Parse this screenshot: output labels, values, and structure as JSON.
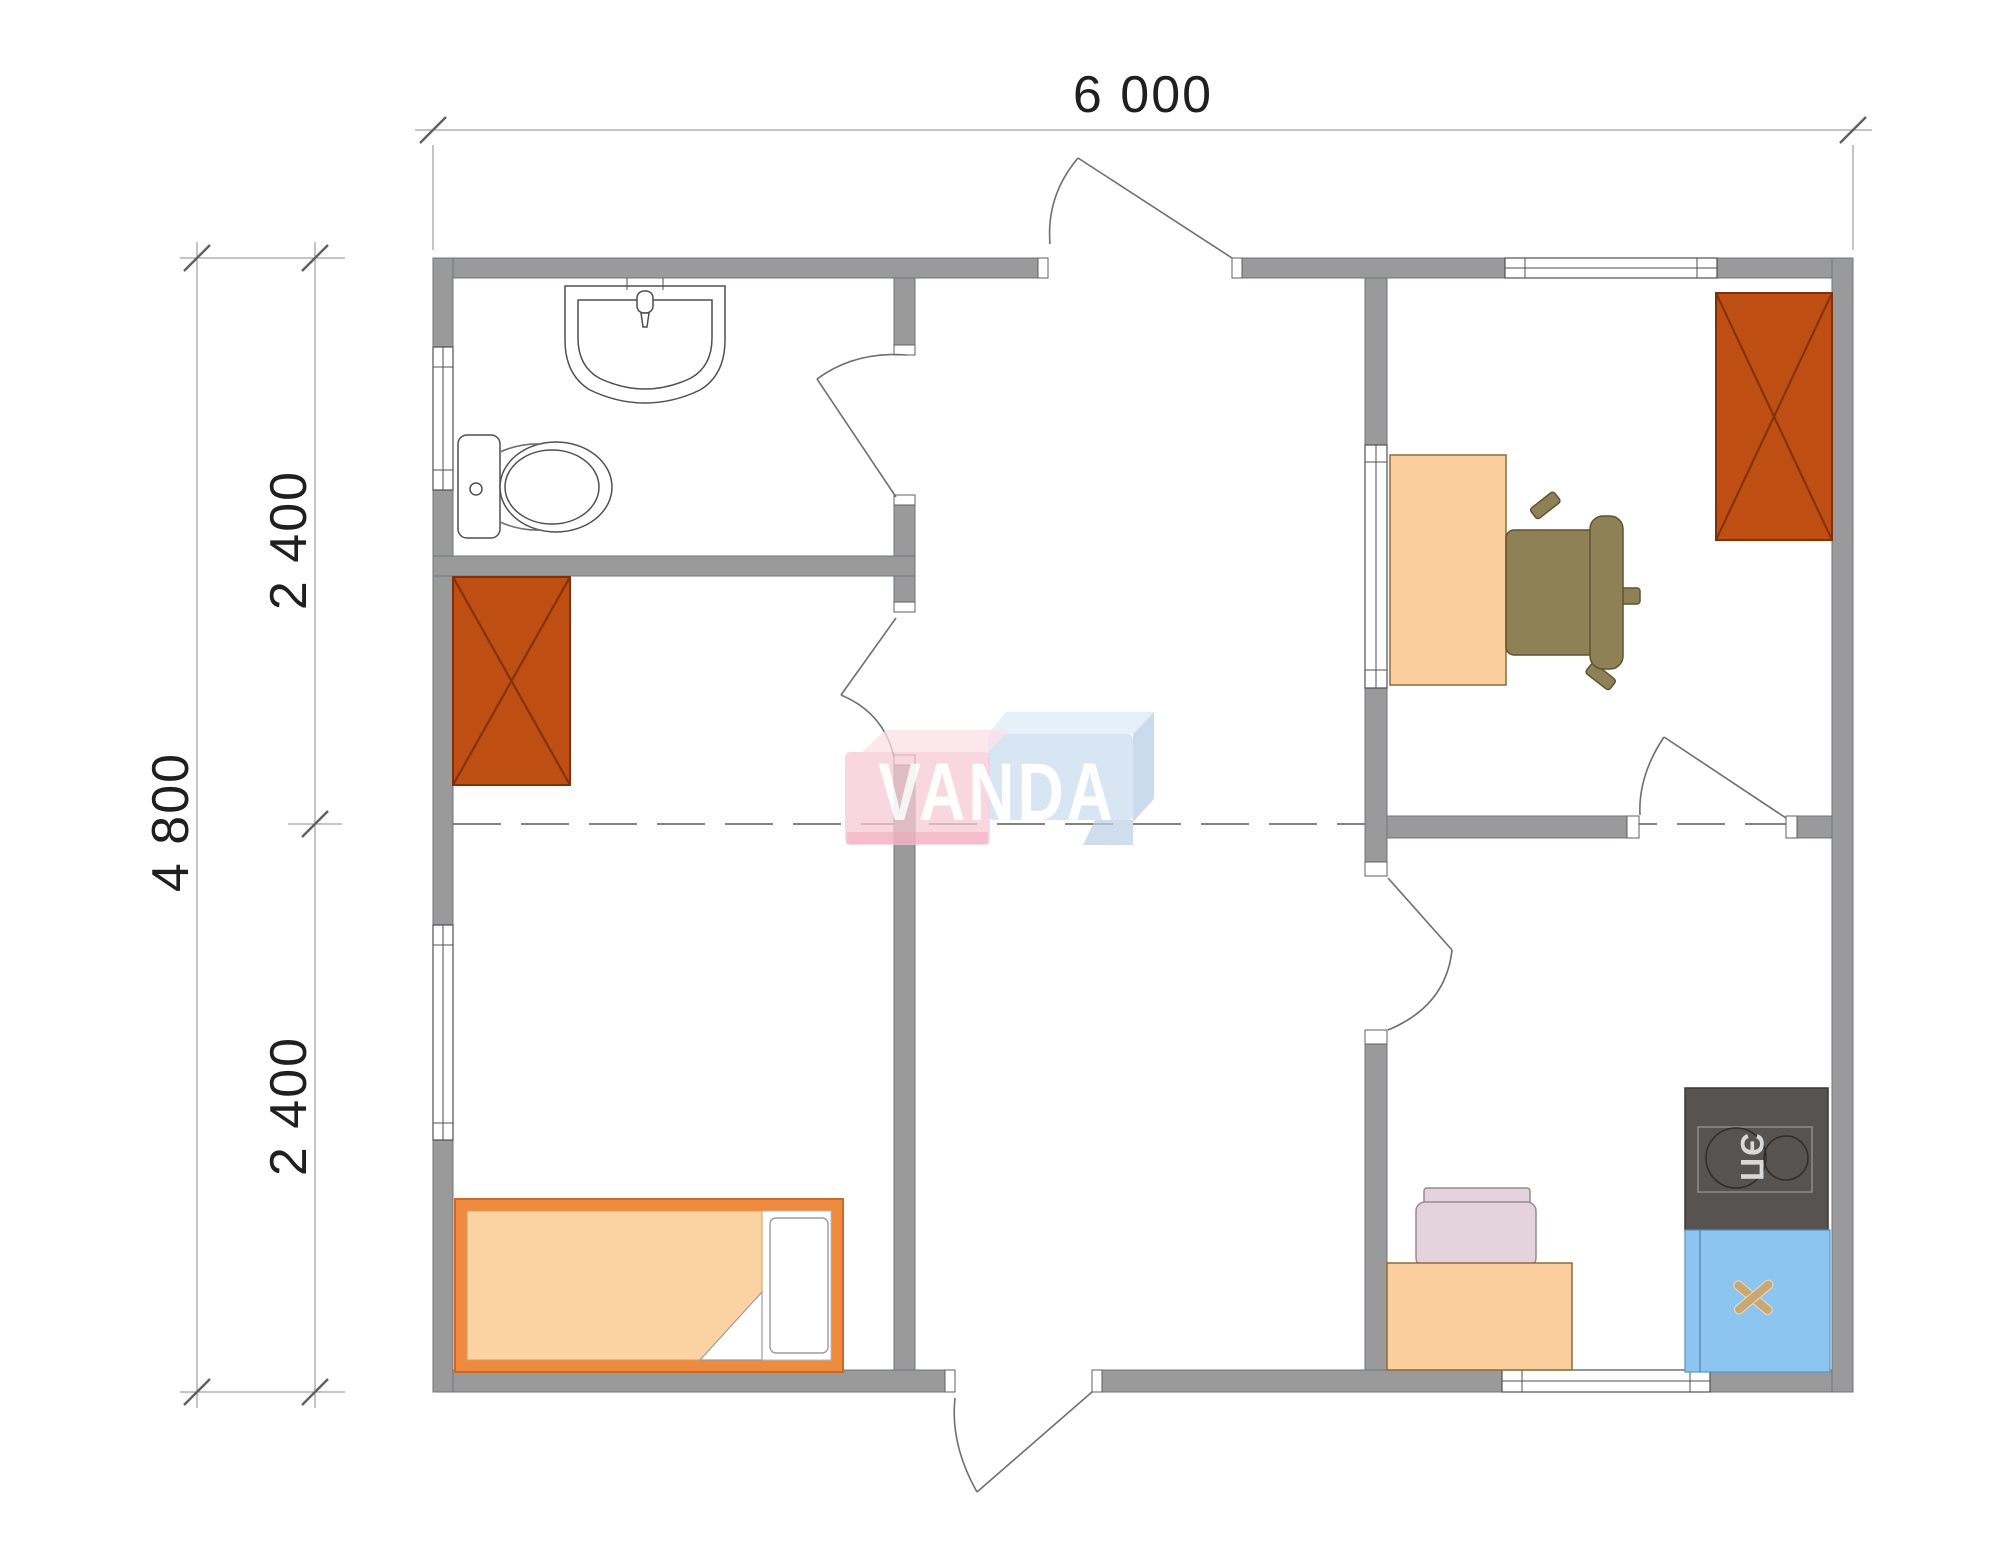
{
  "dimensions": {
    "width_label": "6 000",
    "height_total_label": "4 800",
    "height_upper_label": "2 400",
    "height_lower_label": "2 400"
  },
  "watermark": {
    "text": "VANDA",
    "pink_block": "#F8C9D5",
    "blue_block": "#CBDDF0",
    "text_color": "#FFFFFF"
  },
  "appliances": {
    "stove_label": "ЭП"
  },
  "palette": {
    "wall": "#9A9A9A",
    "wardrobe": "#BF4E13",
    "desk_wood": "#FBCE9D",
    "bed_frame": "#EE8B3E",
    "bed_blanket": "#FBD3A3",
    "office_chair": "#8F8156",
    "kitchen_chair": "#E4D2DC",
    "stove": "#575350",
    "kitchen_sink": "#8CC5F0",
    "sink_cross": "#C9A876"
  },
  "furniture": [
    {
      "name": "washbasin"
    },
    {
      "name": "toilet"
    },
    {
      "name": "wardrobe-left"
    },
    {
      "name": "wardrobe-right"
    },
    {
      "name": "office-desk"
    },
    {
      "name": "office-chair"
    },
    {
      "name": "bed"
    },
    {
      "name": "kitchen-desk"
    },
    {
      "name": "kitchen-chair"
    },
    {
      "name": "electric-stove"
    },
    {
      "name": "kitchen-sink"
    }
  ]
}
